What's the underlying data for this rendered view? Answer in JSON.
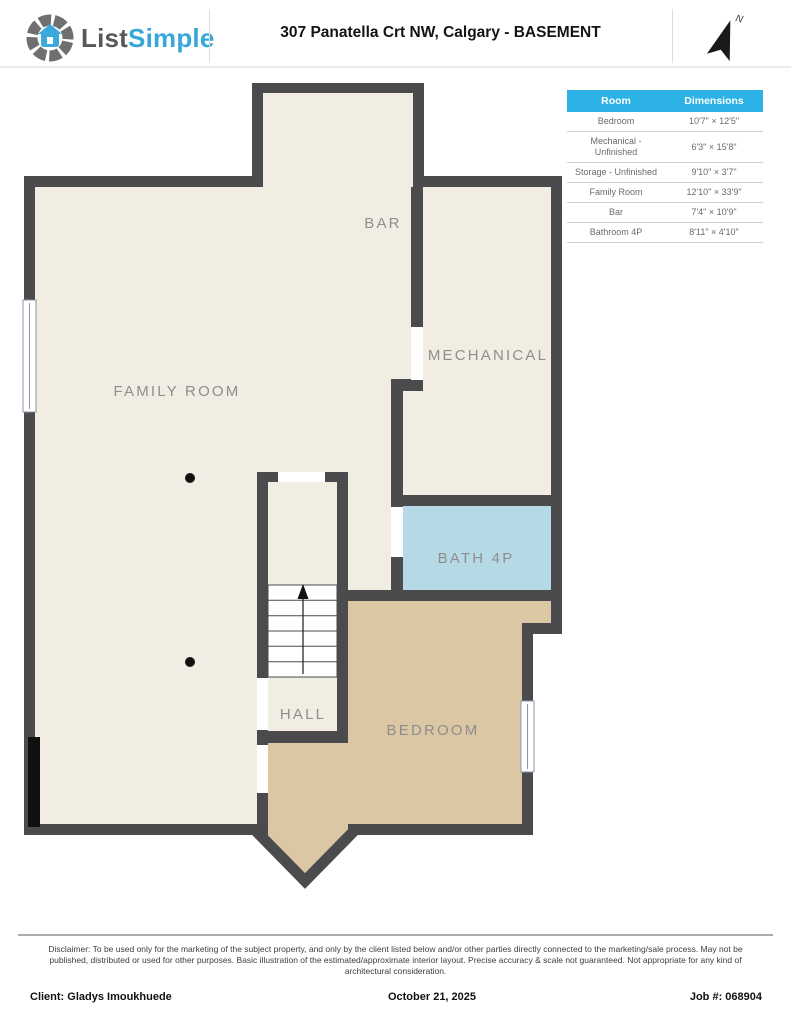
{
  "header": {
    "logo_gray": "List",
    "logo_blue": "Simple",
    "title": "307 Panatella Crt NW, Calgary - BASEMENT",
    "compass_label": "N"
  },
  "dimensions_table": {
    "headers": [
      "Room",
      "Dimensions"
    ],
    "rows": [
      {
        "room": "Bedroom",
        "dims": "10'7\" × 12'5\""
      },
      {
        "room": "Mechanical - Unfinished",
        "dims": "6'3\" × 15'8\""
      },
      {
        "room": "Storage - Unfinished",
        "dims": "9'10\" × 3'7\""
      },
      {
        "room": "Family Room",
        "dims": "12'10\" × 33'9\""
      },
      {
        "room": "Bar",
        "dims": "7'4\" × 10'9\""
      },
      {
        "room": "Bathroom 4P",
        "dims": "8'11\" × 4'10\""
      }
    ]
  },
  "floor_plan": {
    "rooms": [
      {
        "id": "bar",
        "label": "BAR"
      },
      {
        "id": "family-room",
        "label": "FAMILY ROOM"
      },
      {
        "id": "mechanical",
        "label": "MECHANICAL"
      },
      {
        "id": "bath-4p",
        "label": "BATH 4P"
      },
      {
        "id": "hall",
        "label": "HALL"
      },
      {
        "id": "bedroom",
        "label": "BEDROOM"
      }
    ]
  },
  "footer": {
    "disclaimer": "Disclaimer: To be used only for the marketing of the subject property, and only by the client listed below and/or other parties directly connected to the marketing/sale process. May not be published, distributed or used for other purposes. Basic illustration of the estimated/approximate interior layout. Precise accuracy & scale not guaranteed. Not appropriate for any kind of architectural consideration.",
    "client": "Client: Gladys Imoukhuede",
    "date": "October 21, 2025",
    "job": "Job #: 068904"
  },
  "colors": {
    "wall": "#4b4b4d",
    "floor_cream": "#f2ede3",
    "bedroom_tan": "#dcc7a4",
    "bath_blue": "#b6d9e6",
    "table_header_cyan": "#2cb2e4",
    "logo_blue": "#35a7d9",
    "logo_gray": "#57585a",
    "label_gray": "#8e8e8e"
  }
}
